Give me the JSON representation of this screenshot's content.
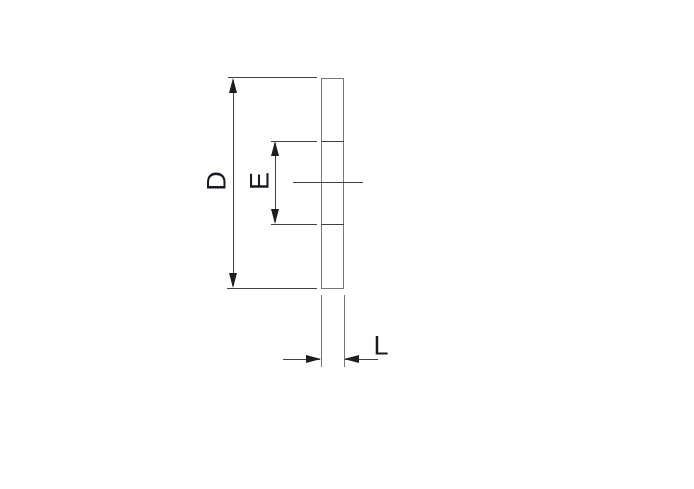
{
  "diagram": {
    "description": "side-view cross-section with dimension callouts",
    "dimension_labels": {
      "d": "D",
      "e": "E",
      "l": "L"
    },
    "colors": {
      "background": "#ffffff",
      "line": "#3f3f3f",
      "outline": "#767676",
      "arrow": "#1e1e1e",
      "text": "#1a1a22"
    }
  }
}
